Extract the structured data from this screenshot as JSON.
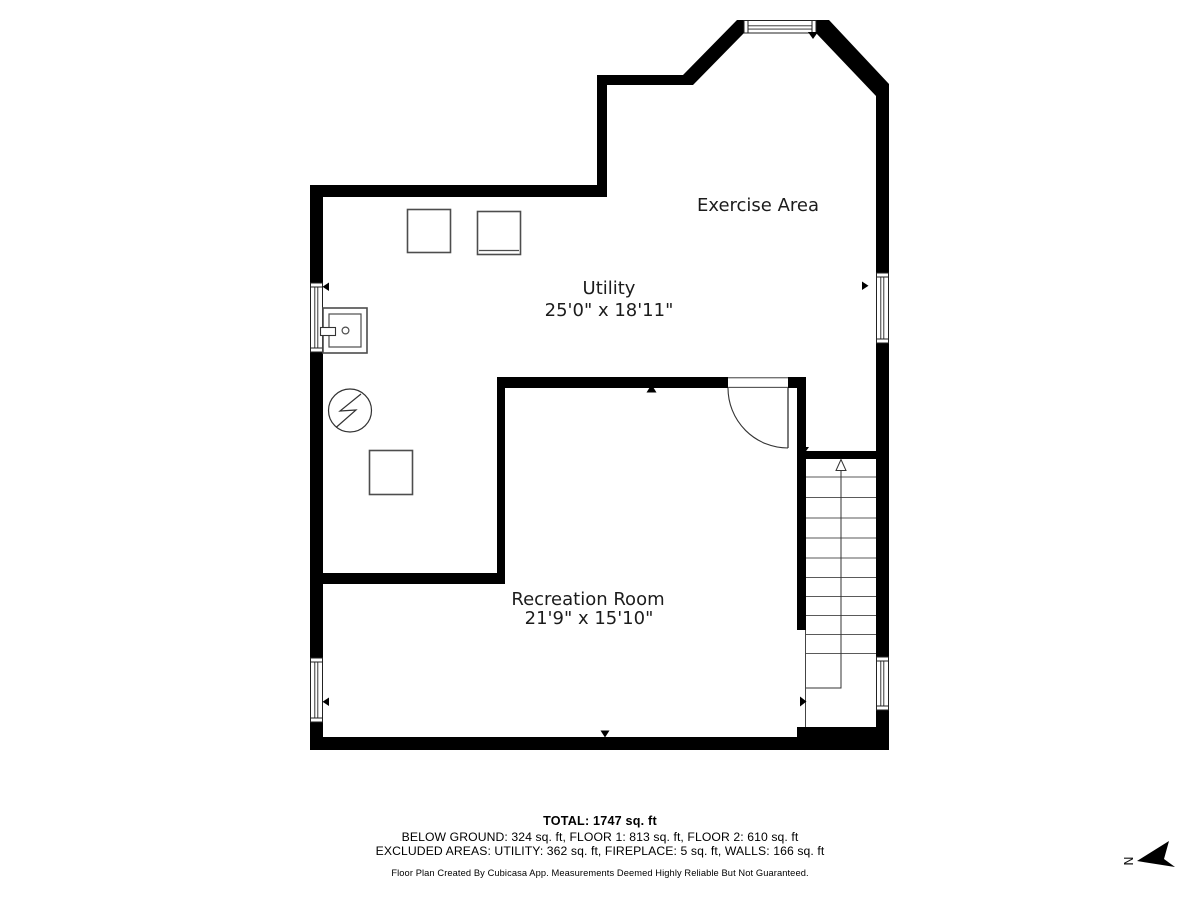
{
  "plan": {
    "rooms": {
      "exercise": {
        "label": "Exercise Area"
      },
      "utility": {
        "label": "Utility",
        "dimensions": "25'0\" x 18'11\""
      },
      "recreation": {
        "label": "Recreation Room",
        "dimensions": "21'9\" x 15'10\""
      }
    },
    "fixtures": [
      "washer-box",
      "dryer-box",
      "storage-box",
      "laundry-sink",
      "electrical-panel"
    ],
    "stairs": {
      "direction": "up"
    }
  },
  "compass": {
    "north_label": "N"
  },
  "footer": {
    "total": "TOTAL: 1747 sq. ft",
    "floor_breakdown": "BELOW GROUND: 324 sq. ft, FLOOR 1: 813 sq. ft, FLOOR 2: 610 sq. ft",
    "excluded_areas": "EXCLUDED AREAS: UTILITY: 362 sq. ft, FIREPLACE: 5 sq. ft, WALLS: 166 sq. ft",
    "disclaimer": "Floor Plan Created By Cubicasa App. Measurements Deemed Highly Reliable But Not Guaranteed."
  },
  "colors": {
    "wall": "#000000",
    "fixture_stroke": "#4d4d4d",
    "background": "#ffffff",
    "text": "#1c1c1c"
  }
}
